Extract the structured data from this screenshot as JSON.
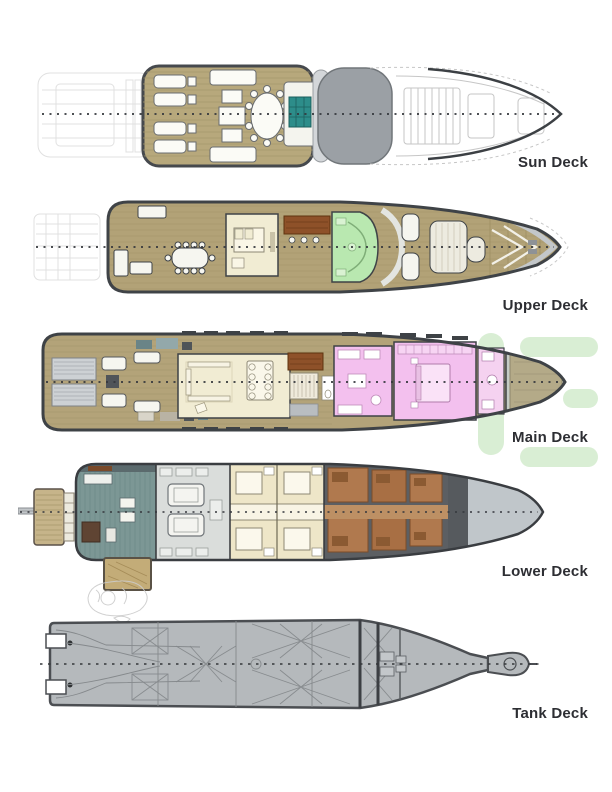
{
  "title": "Yacht deck plans",
  "decks": [
    {
      "id": "sun-deck",
      "label": "Sun Deck",
      "elements": [
        "ghost-aft-deck",
        "sun-loungers",
        "cocktail-table",
        "jacuzzi",
        "radar-arch",
        "ghost-foredeck",
        "centerline"
      ]
    },
    {
      "id": "upper-deck",
      "label": "Upper Deck",
      "elements": [
        "ghost-swim-platform",
        "alfresco-dining-table",
        "skylounge",
        "bar",
        "wheelhouse",
        "sun-pads",
        "foredeck",
        "centerline"
      ]
    },
    {
      "id": "main-deck",
      "label": "Main Deck",
      "elements": [
        "stern-stairs",
        "aft-deck-furniture",
        "main-salon",
        "dining-table",
        "pantry",
        "galley",
        "master-stateroom",
        "master-bath",
        "foredeck-area",
        "centerline"
      ]
    },
    {
      "id": "lower-deck",
      "label": "Lower Deck",
      "elements": [
        "passerelle",
        "swim-platform",
        "beach-club",
        "engine-room",
        "guest-cabins",
        "crew-quarters",
        "bow-stores",
        "ghost-tender",
        "centerline"
      ]
    },
    {
      "id": "tank-deck",
      "label": "Tank Deck",
      "elements": [
        "transom-notches",
        "structural-bracing",
        "bulkheads",
        "propeller-shafts",
        "bulbous-bow",
        "centerline"
      ]
    }
  ],
  "watermark": {
    "name": "green-logo-watermark",
    "color": "#d9eed4"
  },
  "palette": {
    "background": "#ffffff",
    "deck_label_text": "#2d2e33",
    "hull_outline": "#3e4246",
    "teak_wood": "#b3a379",
    "superstructure_gray": "#9ba0a5",
    "jacuzzi_teal": "#2d8d8a",
    "lounge_cream": "#f1ecd3",
    "wheelhouse_green": "#b9e8b0",
    "bar_brown": "#8e5129",
    "cabin_pink": "#f3c0ee",
    "beach_club_teal": "#7c9795",
    "engine_room_gray": "#dadddb",
    "crew_brown": "#b0794e",
    "foredeck_gray": "#c5ccc5",
    "tank_deck_gray": "#b5b9bc",
    "watermark_green": "#d9eed4"
  }
}
